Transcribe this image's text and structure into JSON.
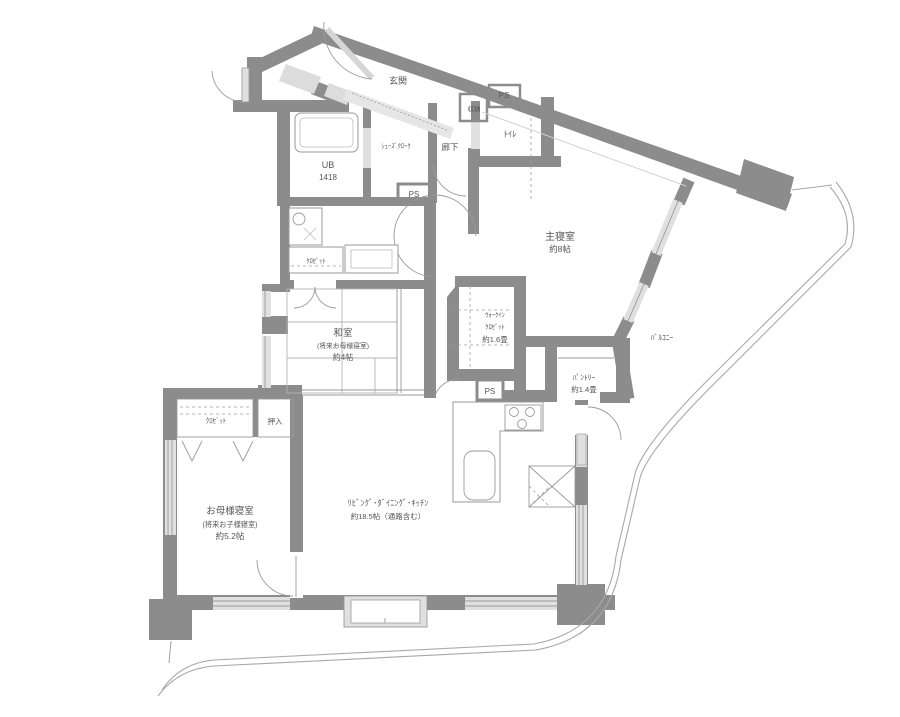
{
  "floorplan": {
    "type": "apartment-floor-plan",
    "colors": {
      "wall": "#8c8c8c",
      "window_fill": "#e0e0e0",
      "line": "#9a9a9a",
      "text": "#555555"
    },
    "rooms": {
      "entrance": {
        "label": "玄関"
      },
      "shoes_cloak": {
        "label": "ｼｭｰｽﾞｸﾛｰｸ"
      },
      "hallway": {
        "label": "廊下"
      },
      "toilet": {
        "label": "ﾄｲﾚ"
      },
      "storage": {
        "label": "収納"
      },
      "pipe_space_top": {
        "label": "PS"
      },
      "pipe_space_mid": {
        "label": "PS"
      },
      "pipe_space_bottom": {
        "label": "PS"
      },
      "unit_bath": {
        "label": "UB",
        "size": "1418"
      },
      "master_bedroom": {
        "label": "主寝室",
        "size": "約8帖"
      },
      "walk_in_closet": {
        "label_line1": "ｳｫｰｸｲﾝ",
        "label_line2": "ｸﾛｾﾞｯﾄ",
        "size": "約1.6畳"
      },
      "pantry": {
        "label": "ﾊﾟﾝﾄﾘｰ",
        "size": "約1.4畳"
      },
      "japanese_room": {
        "label": "和室",
        "sublabel": "(将来お母様寝室)",
        "size": "約4帖"
      },
      "washroom_closet": {
        "label": "ｸﾛｾﾞｯﾄ"
      },
      "mother_closet": {
        "label": "ｸﾛｾﾞｯﾄ"
      },
      "oshiire": {
        "label": "押入"
      },
      "mother_bedroom": {
        "label": "お母様寝室",
        "sublabel": "(将来お子様寝室)",
        "size": "約5.2帖"
      },
      "ldk": {
        "label": "ﾘﾋﾞﾝｸﾞ･ﾀﾞｲﾆﾝｸﾞ･ｷｯﾁﾝ",
        "size": "約18.5帖（通路含む）"
      },
      "balcony": {
        "label": "ﾊﾞﾙｺﾆｰ"
      }
    }
  }
}
